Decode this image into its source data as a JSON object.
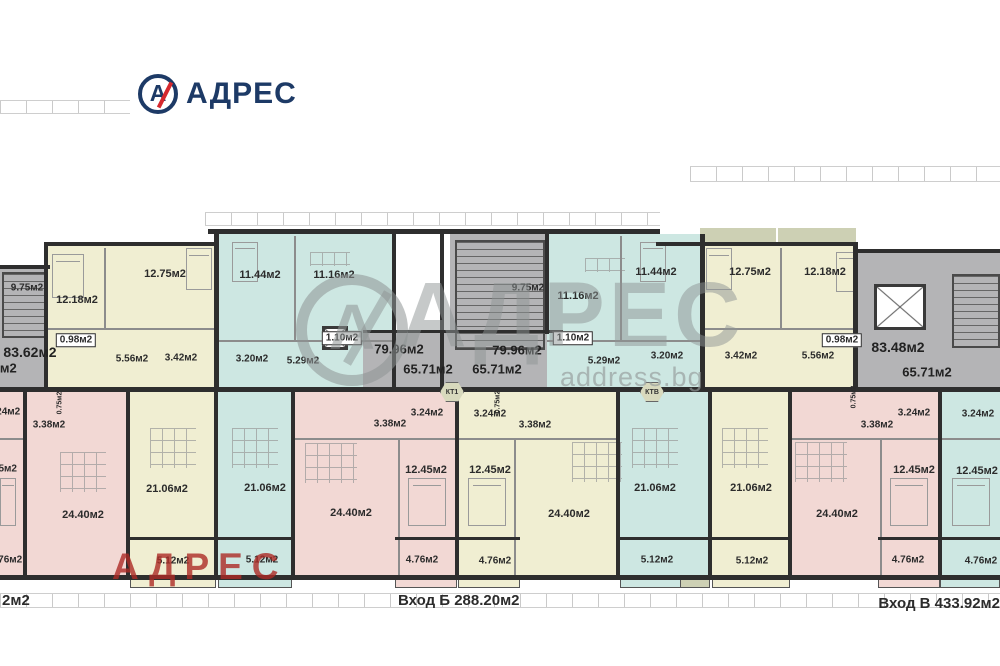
{
  "colors": {
    "yellow": "#f0eed2",
    "pink": "#f2d8d4",
    "cyan": "#cde7e2",
    "gray": "#b4b4b6",
    "olive": "#cdd0b4",
    "wall": "#2e2e2e"
  },
  "brand": {
    "logo_text": "АДРЕС",
    "icon_letter": "А",
    "icon_name": "circle-a-slash-icon",
    "navy": "#1d3a66",
    "red": "#d5282d"
  },
  "watermark": {
    "center_text": "АДРЕС",
    "center_icon_letter": "А",
    "domain": "address.bg",
    "red_text": "АДРЕС"
  },
  "footer": {
    "left_partial": "2м2",
    "entrance_b": "Вход Б 288.20м2",
    "entrance_v": "Вход В 433.92м2"
  },
  "floorplan": {
    "zones": [
      {
        "c": "gray",
        "r": [
          0,
          268,
          52,
          122
        ]
      },
      {
        "c": "yellow",
        "r": [
          48,
          246,
          170,
          144
        ]
      },
      {
        "c": "cyan",
        "r": [
          218,
          234,
          177,
          156
        ]
      },
      {
        "c": "gray",
        "r": [
          363,
          333,
          199,
          57
        ]
      },
      {
        "c": "gray",
        "r": [
          450,
          234,
          95,
          126
        ]
      },
      {
        "c": "cyan",
        "r": [
          547,
          234,
          155,
          156
        ]
      },
      {
        "c": "yellow",
        "r": [
          702,
          246,
          153,
          144
        ]
      },
      {
        "c": "gray",
        "r": [
          857,
          252,
          143,
          138
        ]
      },
      {
        "c": "olive",
        "r": [
          700,
          228,
          76,
          15
        ]
      },
      {
        "c": "olive",
        "r": [
          778,
          228,
          78,
          15
        ]
      },
      {
        "c": "pink",
        "r": [
          0,
          392,
          25,
          186
        ]
      },
      {
        "c": "pink",
        "r": [
          25,
          392,
          103,
          186
        ]
      },
      {
        "c": "yellow",
        "r": [
          128,
          392,
          88,
          186
        ]
      },
      {
        "c": "cyan",
        "r": [
          216,
          392,
          77,
          186
        ]
      },
      {
        "c": "pink",
        "r": [
          293,
          392,
          164,
          186
        ]
      },
      {
        "c": "yellow",
        "r": [
          457,
          392,
          161,
          186
        ]
      },
      {
        "c": "cyan",
        "r": [
          618,
          392,
          92,
          186
        ]
      },
      {
        "c": "yellow",
        "r": [
          710,
          392,
          80,
          186
        ]
      },
      {
        "c": "pink",
        "r": [
          790,
          392,
          150,
          186
        ]
      },
      {
        "c": "cyan",
        "r": [
          940,
          392,
          60,
          186
        ]
      }
    ],
    "walls": [
      [
        208,
        229,
        452,
        5
      ],
      [
        44,
        242,
        172,
        4
      ],
      [
        656,
        242,
        202,
        4
      ],
      [
        855,
        249,
        145,
        4
      ],
      [
        0,
        265,
        50,
        4
      ],
      [
        0,
        387,
        1000,
        5
      ],
      [
        0,
        575,
        1000,
        5
      ],
      [
        363,
        330,
        200,
        3
      ],
      [
        130,
        537,
        86,
        3
      ],
      [
        218,
        537,
        74,
        3
      ],
      [
        395,
        537,
        62,
        3
      ],
      [
        458,
        537,
        62,
        3
      ],
      [
        620,
        537,
        90,
        3
      ],
      [
        712,
        537,
        78,
        3
      ],
      [
        878,
        537,
        62,
        3
      ],
      [
        940,
        537,
        60,
        3
      ],
      [
        44,
        242,
        4,
        148
      ],
      [
        214,
        234,
        5,
        156
      ],
      [
        392,
        229,
        4,
        161
      ],
      [
        440,
        229,
        4,
        161
      ],
      [
        545,
        234,
        4,
        100
      ],
      [
        700,
        234,
        5,
        156
      ],
      [
        853,
        242,
        5,
        148
      ],
      [
        23,
        392,
        4,
        186
      ],
      [
        126,
        392,
        4,
        186
      ],
      [
        214,
        392,
        4,
        186
      ],
      [
        291,
        392,
        4,
        186
      ],
      [
        455,
        392,
        4,
        186
      ],
      [
        616,
        392,
        4,
        186
      ],
      [
        708,
        392,
        4,
        186
      ],
      [
        788,
        392,
        4,
        186
      ],
      [
        938,
        392,
        4,
        186
      ]
    ],
    "parts": [
      [
        104,
        248,
        2,
        82
      ],
      [
        48,
        328,
        170,
        2
      ],
      [
        294,
        236,
        2,
        104
      ],
      [
        218,
        340,
        177,
        2
      ],
      [
        620,
        236,
        2,
        104
      ],
      [
        547,
        340,
        155,
        2
      ],
      [
        780,
        248,
        2,
        82
      ],
      [
        702,
        328,
        153,
        2
      ],
      [
        398,
        440,
        2,
        136
      ],
      [
        514,
        440,
        2,
        136
      ],
      [
        880,
        440,
        2,
        136
      ],
      [
        0,
        438,
        25,
        2
      ],
      [
        293,
        438,
        164,
        2
      ],
      [
        457,
        438,
        161,
        2
      ],
      [
        790,
        438,
        150,
        2
      ],
      [
        940,
        438,
        60,
        2
      ]
    ],
    "stairs": [
      [
        2,
        272,
        44,
        66
      ],
      [
        455,
        240,
        90,
        110
      ],
      [
        952,
        274,
        48,
        74
      ]
    ],
    "lifts": [
      [
        874,
        284,
        52,
        46
      ],
      [
        322,
        326,
        26,
        24
      ]
    ],
    "rails": [
      {
        "c": "yellow",
        "r": [
          130,
          578,
          86,
          10
        ]
      },
      {
        "c": "cyan",
        "r": [
          218,
          578,
          74,
          10
        ]
      },
      {
        "c": "pink",
        "r": [
          395,
          578,
          62,
          10
        ]
      },
      {
        "c": "yellow",
        "r": [
          458,
          578,
          62,
          10
        ]
      },
      {
        "c": "cyan",
        "r": [
          620,
          578,
          90,
          10
        ]
      },
      {
        "c": "yellow",
        "r": [
          712,
          578,
          78,
          10
        ]
      },
      {
        "c": "pink",
        "r": [
          878,
          578,
          62,
          10
        ]
      },
      {
        "c": "cyan",
        "r": [
          940,
          578,
          60,
          10
        ]
      },
      {
        "c": "olive",
        "r": [
          680,
          578,
          30,
          10
        ]
      }
    ],
    "rulers": [
      [
        0,
        100,
        130,
        12
      ],
      [
        690,
        166,
        310,
        14
      ],
      [
        205,
        212,
        455,
        12
      ],
      [
        0,
        593,
        1000,
        13
      ]
    ],
    "labels": [
      {
        "t": "9.75м2",
        "x": 27,
        "y": 288,
        "s": 10
      },
      {
        "t": "12.18м2",
        "x": 77,
        "y": 300,
        "s": 11
      },
      {
        "t": "12.75м2",
        "x": 165,
        "y": 274,
        "s": 11
      },
      {
        "t": "11.44м2",
        "x": 260,
        "y": 275,
        "s": 11
      },
      {
        "t": "11.16м2",
        "x": 334,
        "y": 275,
        "s": 11
      },
      {
        "t": "1.10м2",
        "x": 342,
        "y": 338,
        "s": 10,
        "box": 1
      },
      {
        "t": "0.98м2",
        "x": 76,
        "y": 340,
        "s": 10,
        "box": 1
      },
      {
        "t": "83.62м2",
        "x": 30,
        "y": 352,
        "s": 14
      },
      {
        "t": "65.71м2",
        "x": -8,
        "y": 368,
        "s": 13
      },
      {
        "t": "5.56м2",
        "x": 132,
        "y": 359,
        "s": 10
      },
      {
        "t": "3.42м2",
        "x": 181,
        "y": 358,
        "s": 10
      },
      {
        "t": "3.20м2",
        "x": 252,
        "y": 359,
        "s": 10
      },
      {
        "t": "5.29м2",
        "x": 303,
        "y": 361,
        "s": 10
      },
      {
        "t": "9.75м2",
        "x": 528,
        "y": 288,
        "s": 10
      },
      {
        "t": "79.96м2",
        "x": 399,
        "y": 349,
        "s": 13
      },
      {
        "t": "79.96м2",
        "x": 517,
        "y": 350,
        "s": 13
      },
      {
        "t": "65.71м2",
        "x": 428,
        "y": 369,
        "s": 13
      },
      {
        "t": "65.71м2",
        "x": 497,
        "y": 369,
        "s": 13
      },
      {
        "t": "11.16м2",
        "x": 578,
        "y": 296,
        "s": 11
      },
      {
        "t": "1.10м2",
        "x": 573,
        "y": 338,
        "s": 10,
        "box": 1
      },
      {
        "t": "11.44м2",
        "x": 656,
        "y": 272,
        "s": 11
      },
      {
        "t": "5.29м2",
        "x": 604,
        "y": 361,
        "s": 10
      },
      {
        "t": "3.20м2",
        "x": 667,
        "y": 356,
        "s": 10
      },
      {
        "t": "12.75м2",
        "x": 750,
        "y": 272,
        "s": 11
      },
      {
        "t": "12.18м2",
        "x": 825,
        "y": 272,
        "s": 11
      },
      {
        "t": "3.42м2",
        "x": 741,
        "y": 356,
        "s": 10
      },
      {
        "t": "5.56м2",
        "x": 818,
        "y": 356,
        "s": 10
      },
      {
        "t": "0.98м2",
        "x": 842,
        "y": 340,
        "s": 10,
        "box": 1
      },
      {
        "t": "83.48м2",
        "x": 898,
        "y": 347,
        "s": 14
      },
      {
        "t": "65.71м2",
        "x": 927,
        "y": 372,
        "s": 13
      },
      {
        "t": "3.24м2",
        "x": 4,
        "y": 412,
        "s": 10
      },
      {
        "t": "3.38м2",
        "x": 49,
        "y": 425,
        "s": 10
      },
      {
        "t": "0.75м2",
        "x": 60,
        "y": 403,
        "s": 7,
        "v": 1
      },
      {
        "t": "12.45м2",
        "x": -2,
        "y": 469,
        "s": 10
      },
      {
        "t": "24.40м2",
        "x": 83,
        "y": 515,
        "s": 11
      },
      {
        "t": "4.76м2",
        "x": 6,
        "y": 560,
        "s": 10
      },
      {
        "t": "21.06м2",
        "x": 167,
        "y": 489,
        "s": 11
      },
      {
        "t": "5.12м2",
        "x": 173,
        "y": 561,
        "s": 10
      },
      {
        "t": "21.06м2",
        "x": 265,
        "y": 488,
        "s": 11
      },
      {
        "t": "5.12м2",
        "x": 262,
        "y": 560,
        "s": 10
      },
      {
        "t": "3.38м2",
        "x": 390,
        "y": 424,
        "s": 10
      },
      {
        "t": "3.24м2",
        "x": 427,
        "y": 413,
        "s": 10
      },
      {
        "t": "3.24м2",
        "x": 490,
        "y": 414,
        "s": 10
      },
      {
        "t": "3.38м2",
        "x": 535,
        "y": 425,
        "s": 10
      },
      {
        "t": "0.75м2",
        "x": 498,
        "y": 402,
        "s": 7,
        "v": 1
      },
      {
        "t": "12.45м2",
        "x": 426,
        "y": 470,
        "s": 11
      },
      {
        "t": "12.45м2",
        "x": 490,
        "y": 470,
        "s": 11
      },
      {
        "t": "24.40м2",
        "x": 351,
        "y": 513,
        "s": 11
      },
      {
        "t": "24.40м2",
        "x": 569,
        "y": 514,
        "s": 11
      },
      {
        "t": "4.76м2",
        "x": 422,
        "y": 560,
        "s": 10
      },
      {
        "t": "4.76м2",
        "x": 495,
        "y": 561,
        "s": 10
      },
      {
        "t": "21.06м2",
        "x": 655,
        "y": 488,
        "s": 11
      },
      {
        "t": "5.12м2",
        "x": 657,
        "y": 560,
        "s": 10
      },
      {
        "t": "21.06м2",
        "x": 751,
        "y": 488,
        "s": 11
      },
      {
        "t": "5.12м2",
        "x": 752,
        "y": 561,
        "s": 10
      },
      {
        "t": "0.75м2",
        "x": 854,
        "y": 397,
        "s": 7,
        "v": 1
      },
      {
        "t": "3.38м2",
        "x": 877,
        "y": 425,
        "s": 10
      },
      {
        "t": "3.24м2",
        "x": 914,
        "y": 413,
        "s": 10
      },
      {
        "t": "3.24м2",
        "x": 978,
        "y": 414,
        "s": 10
      },
      {
        "t": "12.45м2",
        "x": 914,
        "y": 470,
        "s": 11
      },
      {
        "t": "12.45м2",
        "x": 977,
        "y": 471,
        "s": 11
      },
      {
        "t": "24.40м2",
        "x": 837,
        "y": 514,
        "s": 11
      },
      {
        "t": "4.76м2",
        "x": 908,
        "y": 560,
        "s": 10
      },
      {
        "t": "4.76м2",
        "x": 981,
        "y": 561,
        "s": 10
      }
    ],
    "stamps": [
      {
        "t": "КТ1",
        "x": 452,
        "y": 392
      },
      {
        "t": "КТВ",
        "x": 652,
        "y": 392
      }
    ],
    "furniture": [
      {
        "k": "bed",
        "r": [
          52,
          254,
          32,
          44
        ]
      },
      {
        "k": "bed",
        "r": [
          186,
          248,
          26,
          42
        ]
      },
      {
        "k": "bed",
        "r": [
          232,
          242,
          26,
          40
        ]
      },
      {
        "k": "bed",
        "r": [
          640,
          242,
          26,
          40
        ]
      },
      {
        "k": "bed",
        "r": [
          706,
          248,
          26,
          42
        ]
      },
      {
        "k": "bed",
        "r": [
          836,
          252,
          22,
          40
        ]
      },
      {
        "k": "bed",
        "r": [
          408,
          478,
          38,
          48
        ]
      },
      {
        "k": "bed",
        "r": [
          468,
          478,
          38,
          48
        ]
      },
      {
        "k": "bed",
        "r": [
          890,
          478,
          38,
          48
        ]
      },
      {
        "k": "bed",
        "r": [
          952,
          478,
          38,
          48
        ]
      },
      {
        "k": "bed",
        "r": [
          0,
          478,
          16,
          48
        ]
      },
      {
        "k": "grid",
        "r": [
          150,
          428,
          46,
          40
        ]
      },
      {
        "k": "grid",
        "r": [
          232,
          428,
          46,
          40
        ]
      },
      {
        "k": "grid",
        "r": [
          305,
          443,
          52,
          40
        ]
      },
      {
        "k": "grid",
        "r": [
          572,
          442,
          50,
          40
        ]
      },
      {
        "k": "grid",
        "r": [
          632,
          428,
          46,
          40
        ]
      },
      {
        "k": "grid",
        "r": [
          722,
          428,
          46,
          40
        ]
      },
      {
        "k": "grid",
        "r": [
          795,
          442,
          52,
          40
        ]
      },
      {
        "k": "grid",
        "r": [
          60,
          452,
          46,
          40
        ]
      },
      {
        "k": "grid",
        "r": [
          585,
          258,
          40,
          14
        ]
      },
      {
        "k": "grid",
        "r": [
          310,
          252,
          40,
          14
        ]
      }
    ]
  }
}
